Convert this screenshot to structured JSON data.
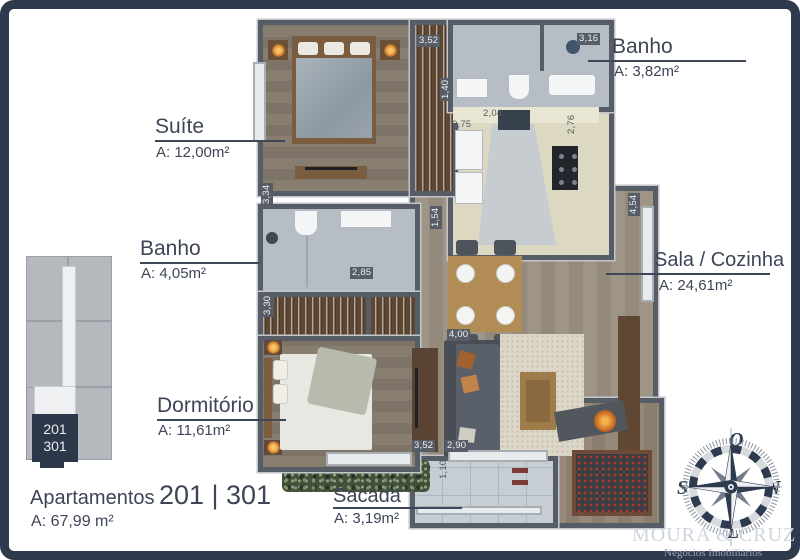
{
  "plan_title": {
    "prefix": "Apartamentos",
    "numbers": "201 | 301",
    "area": "A: 67,99 m²"
  },
  "rooms": {
    "suite": {
      "name": "Suíte",
      "area": "A: 12,00m²"
    },
    "banho_suite": {
      "name": "Banho",
      "area": "A: 3,82m²"
    },
    "banho_social": {
      "name": "Banho",
      "area": "A: 4,05m²"
    },
    "sala_cozinha": {
      "name": "Sala / Cozinha",
      "area": "A: 24,61m²"
    },
    "dormitorio": {
      "name": "Dormitório",
      "area": "A: 11,61m²"
    },
    "sacada": {
      "name": "Sacada",
      "area": "A: 3,19m²"
    }
  },
  "dimensions": [
    {
      "value": "3,52"
    },
    {
      "value": "3,16"
    },
    {
      "value": "1,40"
    },
    {
      "value": "2,04"
    },
    {
      "value": "0,75"
    },
    {
      "value": "2,76"
    },
    {
      "value": "3,34"
    },
    {
      "value": "1,54"
    },
    {
      "value": "2,85"
    },
    {
      "value": "3,30"
    },
    {
      "value": "4,54"
    },
    {
      "value": "4,00"
    },
    {
      "value": "3,52"
    },
    {
      "value": "2,90"
    },
    {
      "value": "1,10"
    }
  ],
  "key_plan": {
    "unit_top": "201",
    "unit_bottom": "301"
  },
  "compass": {
    "top": "O",
    "left": "S",
    "right": "N",
    "bottom": "L"
  },
  "watermark": {
    "line1": "MOURA & CRUZ",
    "line2": "Negócios Imobiliários"
  },
  "colors": {
    "frame": "#2e3a4e",
    "wall": "#575d67",
    "label_text": "#3d4557",
    "highlight_unit": "#2c3749",
    "lamp_glow": "#e08a2e"
  }
}
